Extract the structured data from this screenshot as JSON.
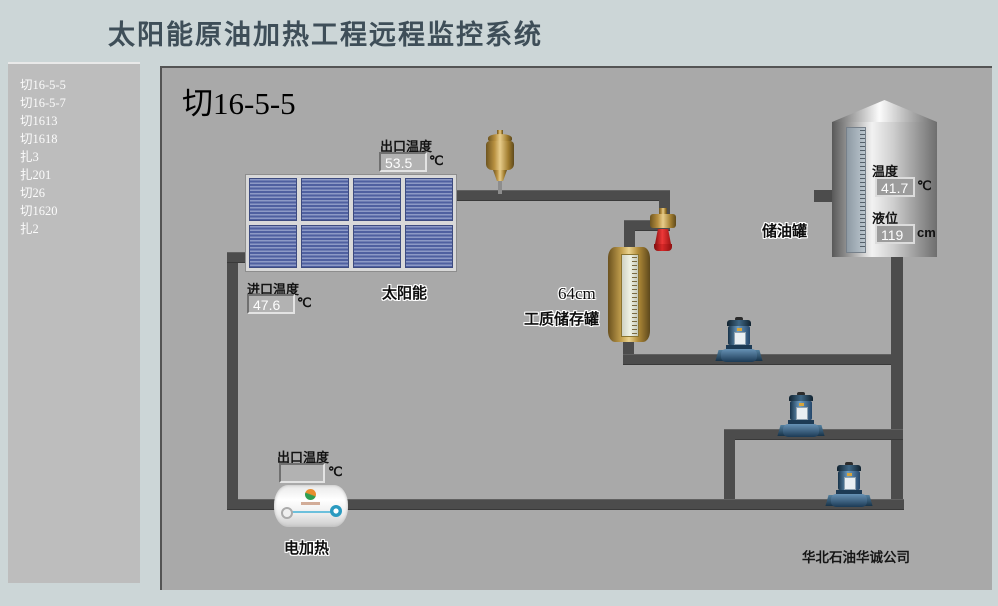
{
  "header": {
    "title": "太阳能原油加热工程远程监控系统"
  },
  "sidebar": {
    "items": [
      "切16-5-5",
      "切16-5-7",
      "切1613",
      "切1618",
      "扎3",
      "扎201",
      "切26",
      "切1620",
      "扎2"
    ]
  },
  "main": {
    "title": "切16-5-5",
    "company": "华北石油华诚公司",
    "solar": {
      "label": "太阳能",
      "outlet_label": "出口温度",
      "outlet_value": "53.5",
      "outlet_unit": "℃",
      "inlet_label": "进口温度",
      "inlet_value": "47.6",
      "inlet_unit": "℃"
    },
    "medium_tank": {
      "level": "64cm",
      "label": "工质储存罐"
    },
    "oil_tank": {
      "label": "储油罐",
      "temp_label": "温度",
      "temp_value": "41.7",
      "temp_unit": "℃",
      "level_label": "液位",
      "level_value": "119",
      "level_unit": "cm"
    },
    "heater": {
      "label": "电加热",
      "outlet_label": "出口温度",
      "outlet_value": "",
      "outlet_unit": "℃"
    },
    "colors": {
      "pipe": "#4c4c4c",
      "panel_background": "#a9a9a9",
      "solar_blue": "#4f60a0",
      "pump_blue": "#2c4f6e",
      "brass": "#c3a04e",
      "valve_red": "#d82828"
    }
  }
}
